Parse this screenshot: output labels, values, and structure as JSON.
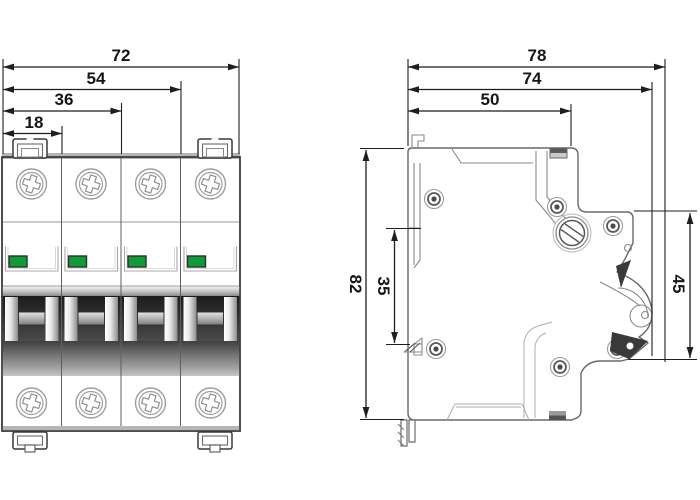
{
  "front_view": {
    "width_dims": [
      {
        "label": "72"
      },
      {
        "label": "54"
      },
      {
        "label": "36"
      },
      {
        "label": "18"
      }
    ]
  },
  "side_view": {
    "depth_dims": [
      {
        "label": "78"
      },
      {
        "label": "74"
      },
      {
        "label": "50"
      }
    ],
    "height_dims": [
      {
        "label": "82"
      },
      {
        "label": "35"
      },
      {
        "label": "45"
      }
    ]
  },
  "colors": {
    "indicator-green": "#0f9c38",
    "dimension-line": "#1e1e1e",
    "body-outline": "#3f3f3f",
    "side-outline": "#6a6a6a",
    "toggle-dark": "#2a2a2a"
  }
}
